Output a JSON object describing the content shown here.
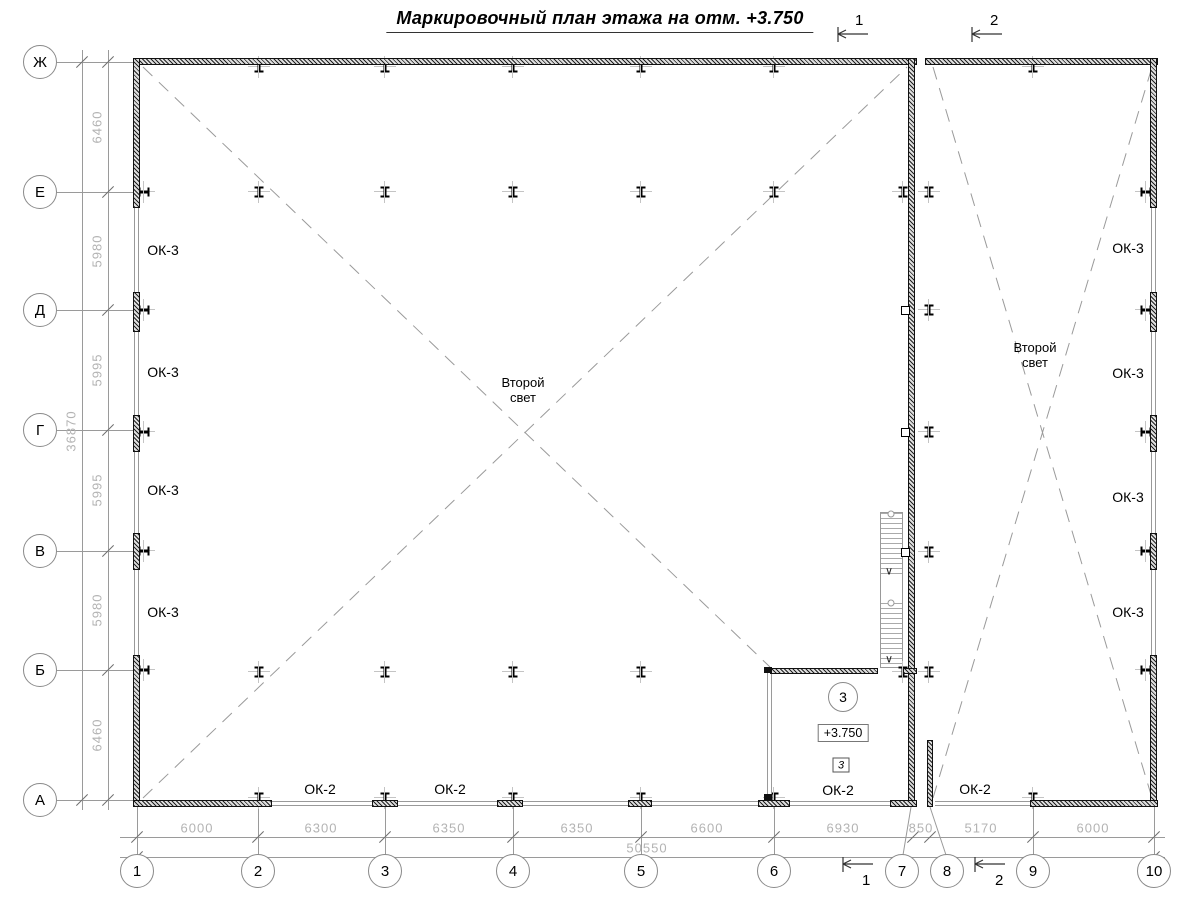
{
  "title": "Маркировочный план этажа на отм. +3.750",
  "axes": {
    "rows": [
      "Ж",
      "Е",
      "Д",
      "Г",
      "В",
      "Б",
      "А"
    ],
    "cols": [
      "1",
      "2",
      "3",
      "4",
      "5",
      "6",
      "7",
      "8",
      "9",
      "10"
    ]
  },
  "dimensions": {
    "left_segments": [
      "6460",
      "5980",
      "5995",
      "5995",
      "5980",
      "6460"
    ],
    "left_total": "36870",
    "bottom_segments": [
      "6000",
      "6300",
      "6350",
      "6350",
      "6600",
      "6930",
      "850",
      "5170",
      "6000"
    ],
    "bottom_total": "50550"
  },
  "labels": {
    "window_ok3": "ОК-3",
    "window_ok2": "ОК-2",
    "second_light": "Второй свет"
  },
  "room": {
    "number": "3",
    "elevation": "+3.750",
    "type_mark": "3",
    "window": "ОК-2"
  },
  "section_marks": {
    "s1": "1",
    "s2": "2"
  }
}
